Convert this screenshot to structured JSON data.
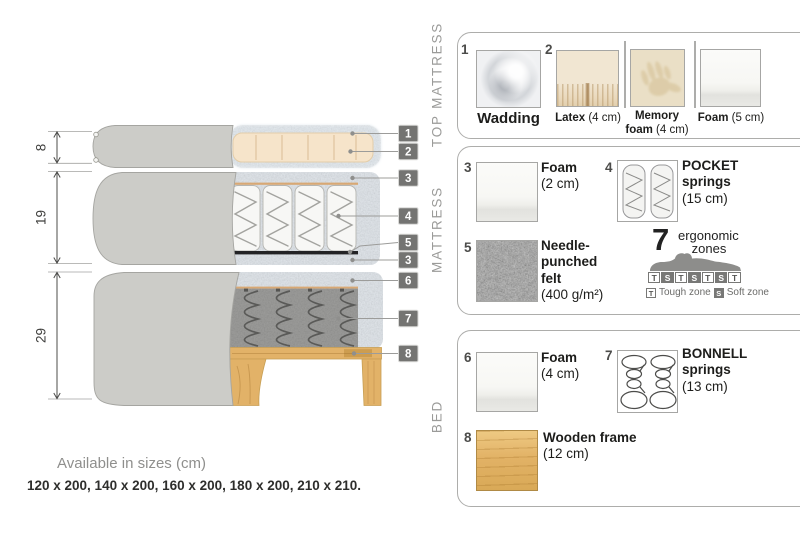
{
  "colors": {
    "badge": "#747472",
    "wood": "#e2b268",
    "cover_fabric": "#ccccc8",
    "wadding_fuzz": "#e2e9ef",
    "felt": "#6f6f6d",
    "accent_text": "#1d1d1b",
    "muted_text": "#9b9b99"
  },
  "diagram": {
    "dims": [
      "8",
      "19",
      "29"
    ],
    "callouts": [
      "1",
      "2",
      "3",
      "4",
      "5",
      "3",
      "6",
      "7",
      "8"
    ]
  },
  "legend": {
    "top_mattress": {
      "title": "TOP MATTRESS",
      "wadding_num": "1",
      "wadding_label": "Wadding",
      "latex_num": "2",
      "latex_name": "Latex",
      "latex_size": "(4 cm)",
      "memory_name1": "Memory",
      "memory_name2": "foam",
      "memory_size": "(4 cm)",
      "foam_name": "Foam",
      "foam_size": "(5 cm)"
    },
    "mattress": {
      "title": "MATTRESS",
      "foam_num": "3",
      "foam_name": "Foam",
      "foam_size": "(2 cm)",
      "pocket_num": "4",
      "pocket_name1": "POCKET",
      "pocket_name2": "springs",
      "pocket_size": "(15 cm)",
      "felt_num": "5",
      "felt_name1": "Needle-",
      "felt_name2": "punched",
      "felt_name3": "felt",
      "felt_size": "(400 g/m²)",
      "ergo_count": "7",
      "ergo_word1": "ergonomic",
      "ergo_word2": "zones",
      "zones": [
        "T",
        "S",
        "T",
        "S",
        "T",
        "S",
        "T"
      ],
      "tough_key": "T",
      "tough_label": "Tough zone",
      "soft_key": "S",
      "soft_label": "Soft zone"
    },
    "bed": {
      "title": "BED",
      "foam_num": "6",
      "foam_name": "Foam",
      "foam_size": "(4 cm)",
      "bonnell_num": "7",
      "bonnell_name1": "BONNELL",
      "bonnell_name2": "springs",
      "bonnell_size": "(13 cm)",
      "frame_num": "8",
      "frame_name": "Wooden frame",
      "frame_size": "(12 cm)"
    }
  },
  "footer": {
    "sizes_title": "Available in sizes (cm)",
    "sizes_list": "120 x 200, 140 x 200, 160 x 200, 180 x 200, 210 x 210."
  }
}
